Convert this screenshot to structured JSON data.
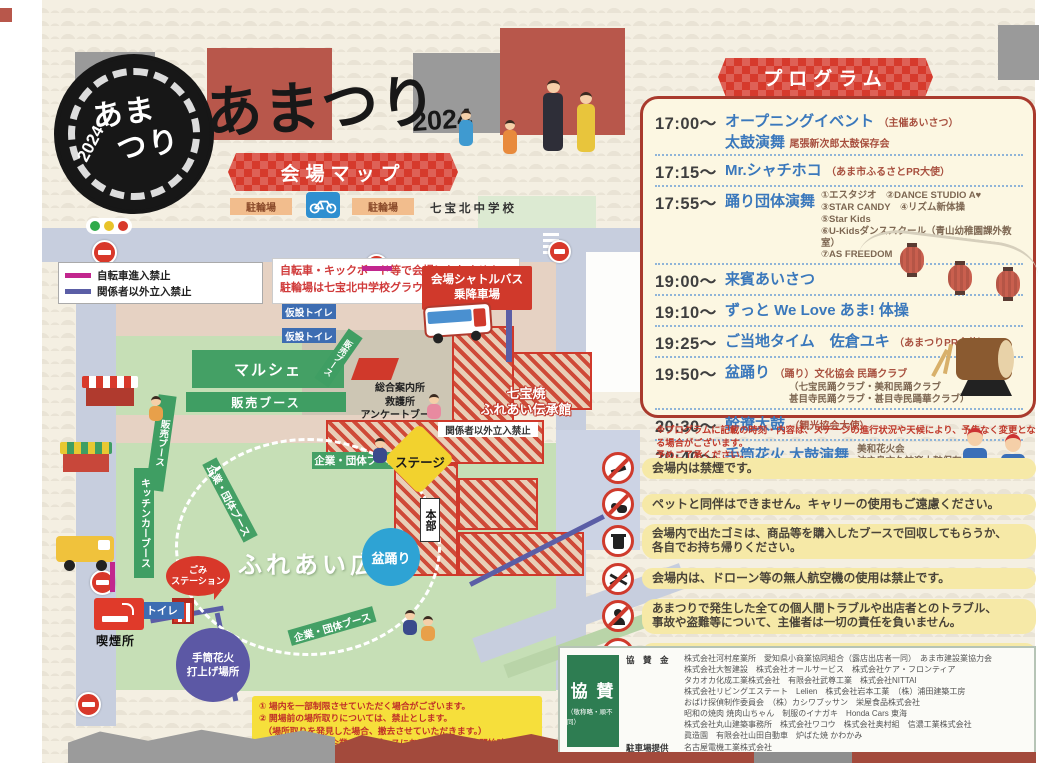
{
  "header": {
    "logo_line1": "あま",
    "logo_line2": "つり",
    "logo_year": "2024",
    "title": "あまつり",
    "title_year": "2024"
  },
  "map": {
    "banner": "会場マップ",
    "bike_parking_left": "駐輪場",
    "bike_parking_right": "駐輪場",
    "school_name": "七宝北中学校",
    "legend": {
      "bike": "自転車進入禁止",
      "staff": "関係者以外立入禁止",
      "bike_color": "#c2268e",
      "staff_color": "#5b5ea6"
    },
    "warning1": "自転車・キックボード等で会場に入れません",
    "warning2": "駐輪場は七宝北中学校グラウンドにあります",
    "shuttle1": "会場シャトルバス",
    "shuttle2": "乗降車場",
    "temp_toilet": "仮設トイレ",
    "marche": "マルシェ",
    "sales_booth": "販売ブース",
    "info1": "総合案内所",
    "info2": "救護所",
    "info3": "アンケートブース",
    "denshokan1": "七宝焼",
    "denshokan2": "ふれあい伝承館",
    "restricted": "関係者以外立入禁止",
    "corporate_booth": "企業・団体ブース",
    "stage": "ステージ",
    "hq": "本部",
    "bonodori": "盆踊り",
    "plaza": "ふれあい広場",
    "kitchen_car": "キッチンカーブース",
    "trash1": "ごみ",
    "trash2": "ステーション",
    "toilet": "トイレ",
    "smoking": "喫煙所",
    "fireworks1": "手筒花火",
    "fireworks2": "打上げ場所"
  },
  "program": {
    "banner": "プログラム",
    "items": [
      {
        "time": "17:00〜",
        "title": "オープニングイベント",
        "note": "（主催あいさつ）",
        "title2": "太鼓演舞",
        "note2": "尾張新次郎太鼓保存会"
      },
      {
        "time": "17:15〜",
        "title": "Mr.シャチホコ",
        "note": "（あま市ふるさとPR大使）"
      },
      {
        "time": "17:55〜",
        "title": "踊り団体演舞",
        "detail1": "①エスタジオ　②DANCE STUDIO A♥",
        "detail2": "③STAR CANDY　④リズム新体操",
        "detail3": "⑤Star Kids",
        "detail4": "⑥U-Kidsダンススクール（青山幼稚園課外教室）",
        "detail5": "⑦AS FREEDOM"
      },
      {
        "time": "19:00〜",
        "title": "来賓あいさつ"
      },
      {
        "time": "19:10〜",
        "title": "ずっと We Love あま! 体操"
      },
      {
        "time": "19:25〜",
        "title": "ご当地タイム　佐倉ユキ",
        "note": "（あまつりPR大使）"
      },
      {
        "time": "19:50〜",
        "title": "盆踊り",
        "note": "（踊り）文化協会 民踊クラブ",
        "detail1": "（七宝民踊クラブ・美和民踊クラブ",
        "detail2": "甚目寺民踊クラブ・甚目寺民踊華クラブ）"
      },
      {
        "time": "20:30〜",
        "title": "幹遼太鼓",
        "note": "（観光協会大使）"
      },
      {
        "time": "20:40〜",
        "title": "手筒花火 太鼓演舞",
        "detail1": "美和花火会",
        "detail2": "沖之島文久神楽太鼓保存会"
      }
    ],
    "footnote1": "※プログラムに記載の時刻・内容は、ステージの進行状況や天候により、予告なく変更となる場合がございます。",
    "footnote2": "予めご了承ください。"
  },
  "notices": [
    {
      "icon": "no-smoking-icon",
      "text1": "会場内は禁煙です。"
    },
    {
      "icon": "no-pets-icon",
      "text1": "ペットと同伴はできません。キャリーの使用もご遠慮ください。"
    },
    {
      "icon": "trash-icon",
      "text1": "会場内で出たゴミは、商品等を購入したブースで回収してもらうか、",
      "text2": "各自でお持ち帰りください。"
    },
    {
      "icon": "no-drone-icon",
      "text1": "会場内は、ドローン等の無人航空機の使用は禁止です。"
    },
    {
      "icon": "no-theft-icon",
      "text1": "あまつりで発生した全ての個人間トラブルや出店者とのトラブル、",
      "text2": "事故や盗難等について、主催者は一切の責任を負いません。"
    },
    {
      "icon": "camera-icon",
      "text1": "会場内の映像や写真を公開することがあります。"
    }
  ],
  "site_notes": {
    "line1": "① 場内を一部制限させていただく場合がございます。",
    "line2": "② 開場前の場所取りについては、禁止とします。",
    "line3": "　（場所取りを発見した場合、撤去させていただきます。）",
    "line4": "③ 販売ブース及び企業・団体ブースにおける全ての販売開始時間は16:00〜となります。"
  },
  "sponsors": {
    "label": "協 賛",
    "label_note": "（敬称略・順不同）",
    "money_label": "協　賛　金",
    "lines": [
      "株式会社河村産業所　愛知県小商業協同組合（露店出店者一同）　あま市建設業協力会",
      "株式会社大智建設　株式会社オールサービス　株式会社ケア・フロンティア",
      "タカオカ化成工業株式会社　有限会社武尊工業　株式会社NITTAI",
      "株式会社リビングエステート　Lelien　株式会社岩本工業　（株）浦田建築工房",
      "おばけ探偵制作委員会　（株）カシワブッサン　栄屋食品株式会社",
      "昭和の焼肉 焼肉山ちゃん　制服のイナガキ　Honda Cars 東海",
      "株式会社丸山建築事務所　株式会社ワコウ　株式会社奥村組　信濃工業株式会社",
      "眞造園　有限会社山田自動車　炉ばた焼 かわかみ"
    ],
    "parking_label": "駐車場提供",
    "parking_value": "名古屋電機工業株式会社"
  },
  "colors": {
    "accent_red": "#d0392b",
    "program_blue": "#3a78bc",
    "notice_yellow": "#f6e9a7",
    "map_green": "#c6dfb6",
    "booth_green": "#3f9e63",
    "no_bike_line": "#c2268e",
    "restricted_line": "#5b5ea6"
  }
}
